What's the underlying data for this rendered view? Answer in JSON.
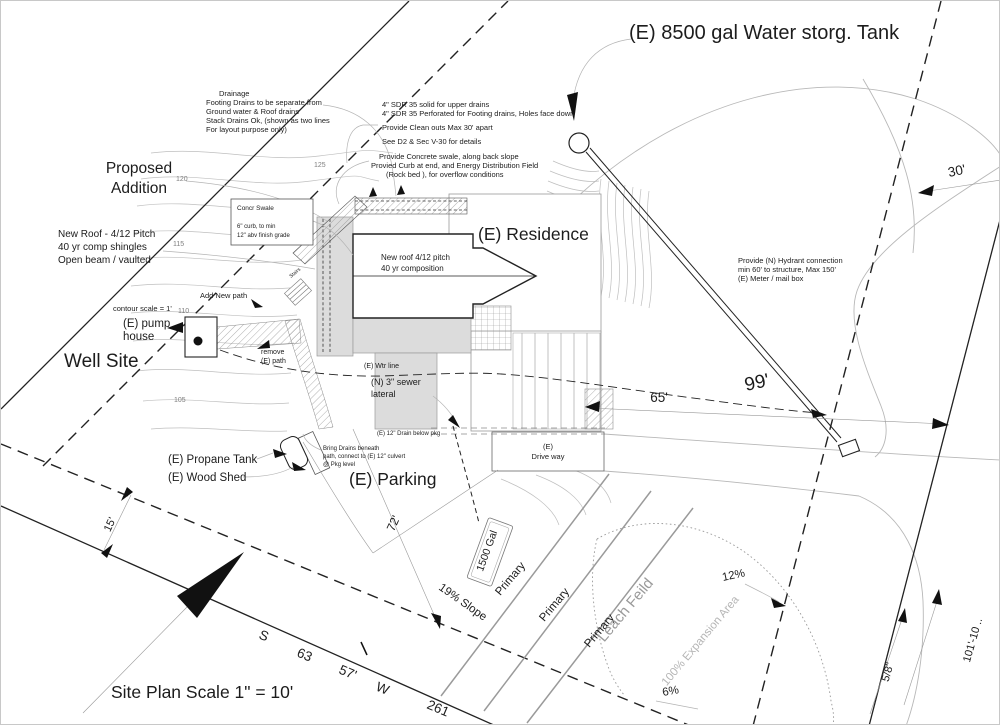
{
  "title": {
    "water_tank": "(E) 8500 gal Water storg. Tank"
  },
  "areas": {
    "proposed_addition_1": "Proposed",
    "proposed_addition_2": "Addition",
    "well_site": "Well Site",
    "residence": "(E) Residence",
    "parking": "(E) Parking",
    "driveway_1": "(E)",
    "driveway_2": "Drive way",
    "leach_field": "Leach Feild",
    "expansion": "100% Expansion Area",
    "primary": "Primary"
  },
  "structures": {
    "pump_house_1": "(E) pump",
    "pump_house_2": "house",
    "propane_tank": "(E)  Propane Tank",
    "wood_shed": "(E) Wood Shed",
    "septic_tank": "1500 Gal",
    "stairs": "Stairs"
  },
  "notes": {
    "drainage": [
      "Drainage",
      "Footing Drains to be separate from",
      "Ground water & Roof drains",
      "Stack Drains Ok, (shown as two lines",
      "For layout purpose only)"
    ],
    "sdr": [
      "4\" SDR 35 solid for upper drains",
      "4\" SDR 35 Perforated for Footing drains, Holes face down",
      "Provide Clean outs Max 30' apart",
      "See D2 & Sec V-30 for details"
    ],
    "swale": [
      "Provide Concrete swale, along back slope",
      "Provied Curb at end, and Energy Distribution Field",
      "(Rock bed ), for overflow conditions"
    ],
    "concr_swale": [
      "Concr Swale",
      "6\" curb, to min",
      "12\" abv finish grade"
    ],
    "new_roof": [
      "New Roof - 4/12 Pitch",
      "40 yr comp shingles",
      "Open beam  / vaulted"
    ],
    "roof_plan": [
      "New roof  4/12 pitch",
      "40 yr composition"
    ],
    "hydrant": [
      "Provide  (N) Hydrant connection",
      "min 60' to structure, Max 150'",
      "(E) Meter / mail box"
    ],
    "bring_drains": [
      "Bring Drains beneath",
      "path, connect to (E) 12\" culvert",
      "@ Pkg level"
    ],
    "drain_below_pkg": "(E) 12\" Drain below pkg",
    "wtr_line": "(E) Wtr line",
    "sewer": [
      "(N) 3\" sewer",
      "lateral"
    ],
    "add_new_path": "Add New path",
    "remove_path": [
      "remove",
      "(E) path"
    ],
    "contour_scale": "contour scale = 1'"
  },
  "dimensions": {
    "d65": "65'",
    "d99": "99'",
    "d30": "30'",
    "d15": "15'",
    "d72": "72'",
    "d101": "101'-10 ..",
    "d58": "5/8\"",
    "slope19": "19% Slope",
    "pct12": "12%",
    "pct6": "6%"
  },
  "contours": {
    "c125": "125",
    "c120": "120",
    "c115": "115",
    "c110": "110",
    "c105": "105"
  },
  "footer": {
    "site_plan": "Site Plan   Scale  1\" = 10'",
    "bearing_s": "S",
    "bearing_deg": "63",
    "bearing_min": "57'",
    "bearing_w": "W",
    "bearing_dist": "261"
  },
  "colors": {
    "ink": "#1c1c1c",
    "contour": "#bfbfbf",
    "gray_fill": "#dcdcdc",
    "leach_gray": "#9a9a9a"
  }
}
